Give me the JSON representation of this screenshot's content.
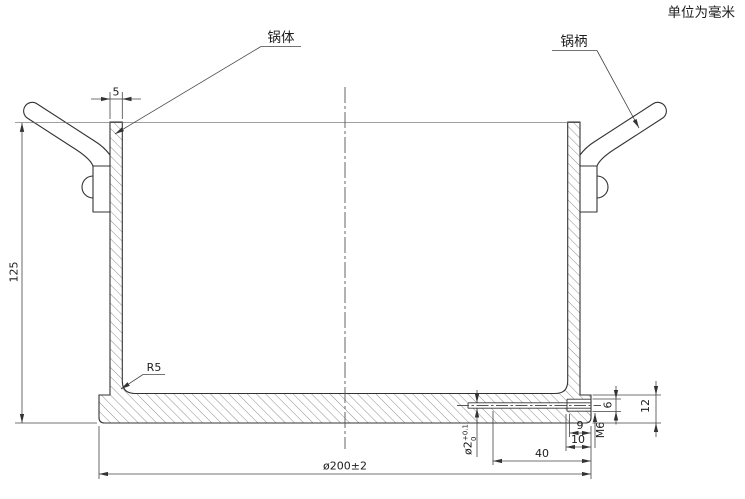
{
  "note": "单位为毫米",
  "labels": {
    "pot_body": "锅体",
    "pot_handle": "锅柄",
    "corner_radius": "R5",
    "thread": "M6"
  },
  "dims": {
    "wall_thickness": "5",
    "height": "125",
    "outer_diameter": "ø200±2",
    "hole_length": "40",
    "thread_depth": "9",
    "hole_depth": "10",
    "thread_diameter": "6",
    "bottom_thickness": "12",
    "small_hole_diameter": "ø2",
    "small_hole_tol_plus": "+0.1",
    "small_hole_tol_minus": "0"
  }
}
